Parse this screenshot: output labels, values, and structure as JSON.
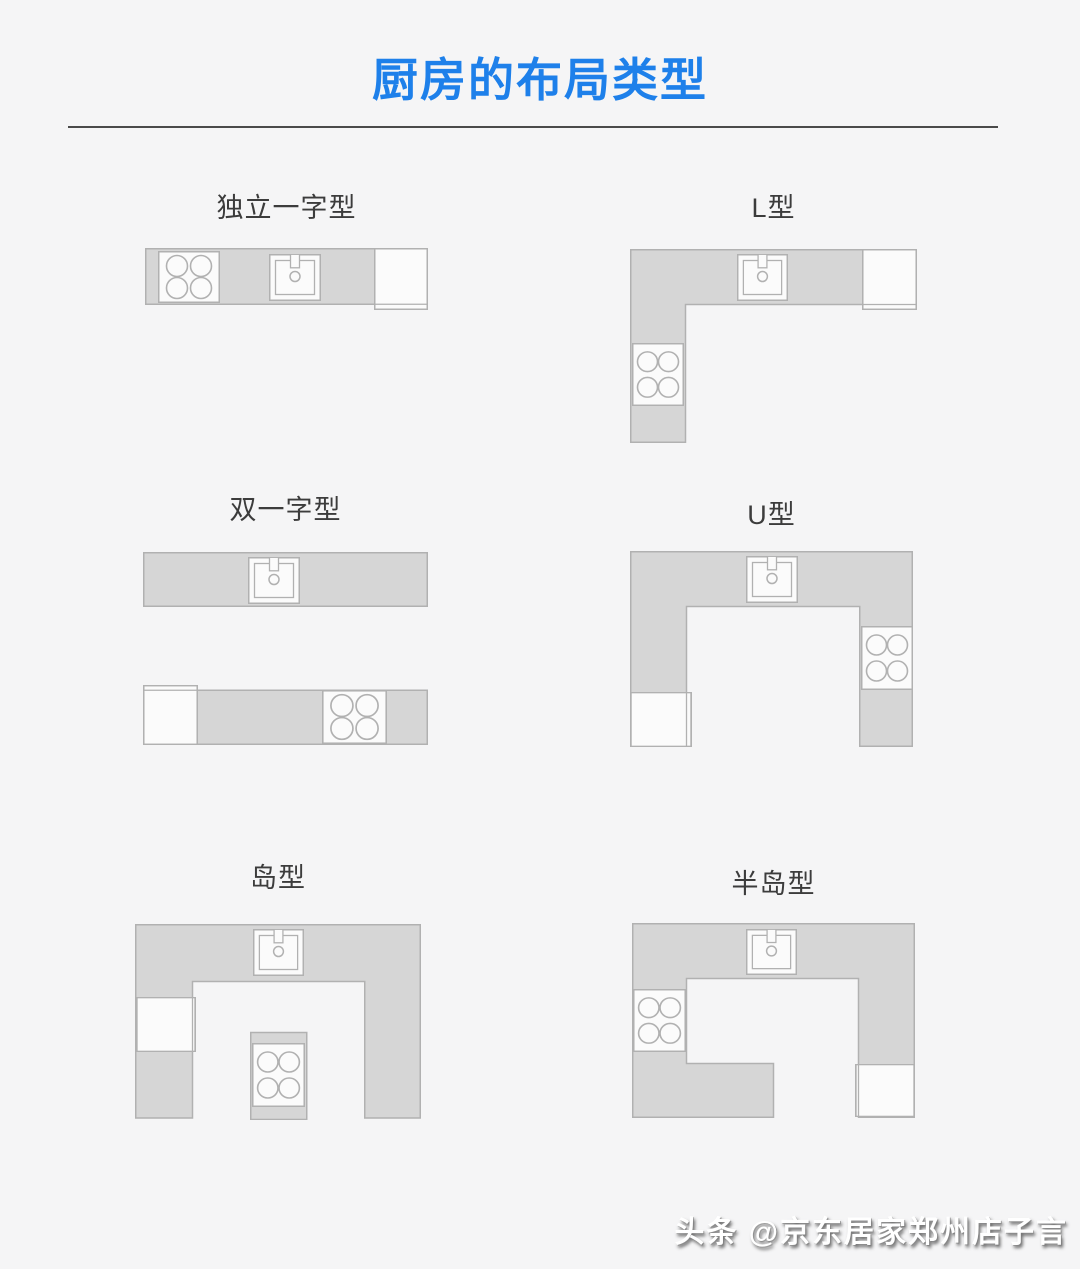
{
  "page": {
    "title": "厨房的布局类型",
    "watermark": "头条 @京东居家郑州店子言"
  },
  "colors": {
    "accent_blue": "#1e80ea",
    "divider_gray": "#4a4a4a",
    "label_text": "#3c3c3c",
    "counter_fill": "#d6d6d6",
    "counter_border": "#b1b1b1",
    "appliance_fill": "#fbfbfb",
    "background": "#f5f5f6",
    "watermark_color": "#ffffff"
  },
  "layouts": [
    {
      "id": "single-line",
      "label": "独立一字型",
      "appliances": [
        "stove-icon",
        "sink-icon",
        "fridge-box"
      ]
    },
    {
      "id": "l-shape",
      "label": "L型",
      "appliances": [
        "sink-icon",
        "fridge-box",
        "stove-icon"
      ]
    },
    {
      "id": "double-line",
      "label": "双一字型",
      "appliances": [
        "sink-icon",
        "fridge-box",
        "stove-icon"
      ]
    },
    {
      "id": "u-shape",
      "label": "U型",
      "appliances": [
        "sink-icon",
        "stove-icon",
        "fridge-box"
      ]
    },
    {
      "id": "island",
      "label": "岛型",
      "appliances": [
        "sink-icon",
        "fridge-box",
        "stove-icon"
      ]
    },
    {
      "id": "peninsula",
      "label": "半岛型",
      "appliances": [
        "sink-icon",
        "stove-icon",
        "fridge-box"
      ]
    }
  ]
}
